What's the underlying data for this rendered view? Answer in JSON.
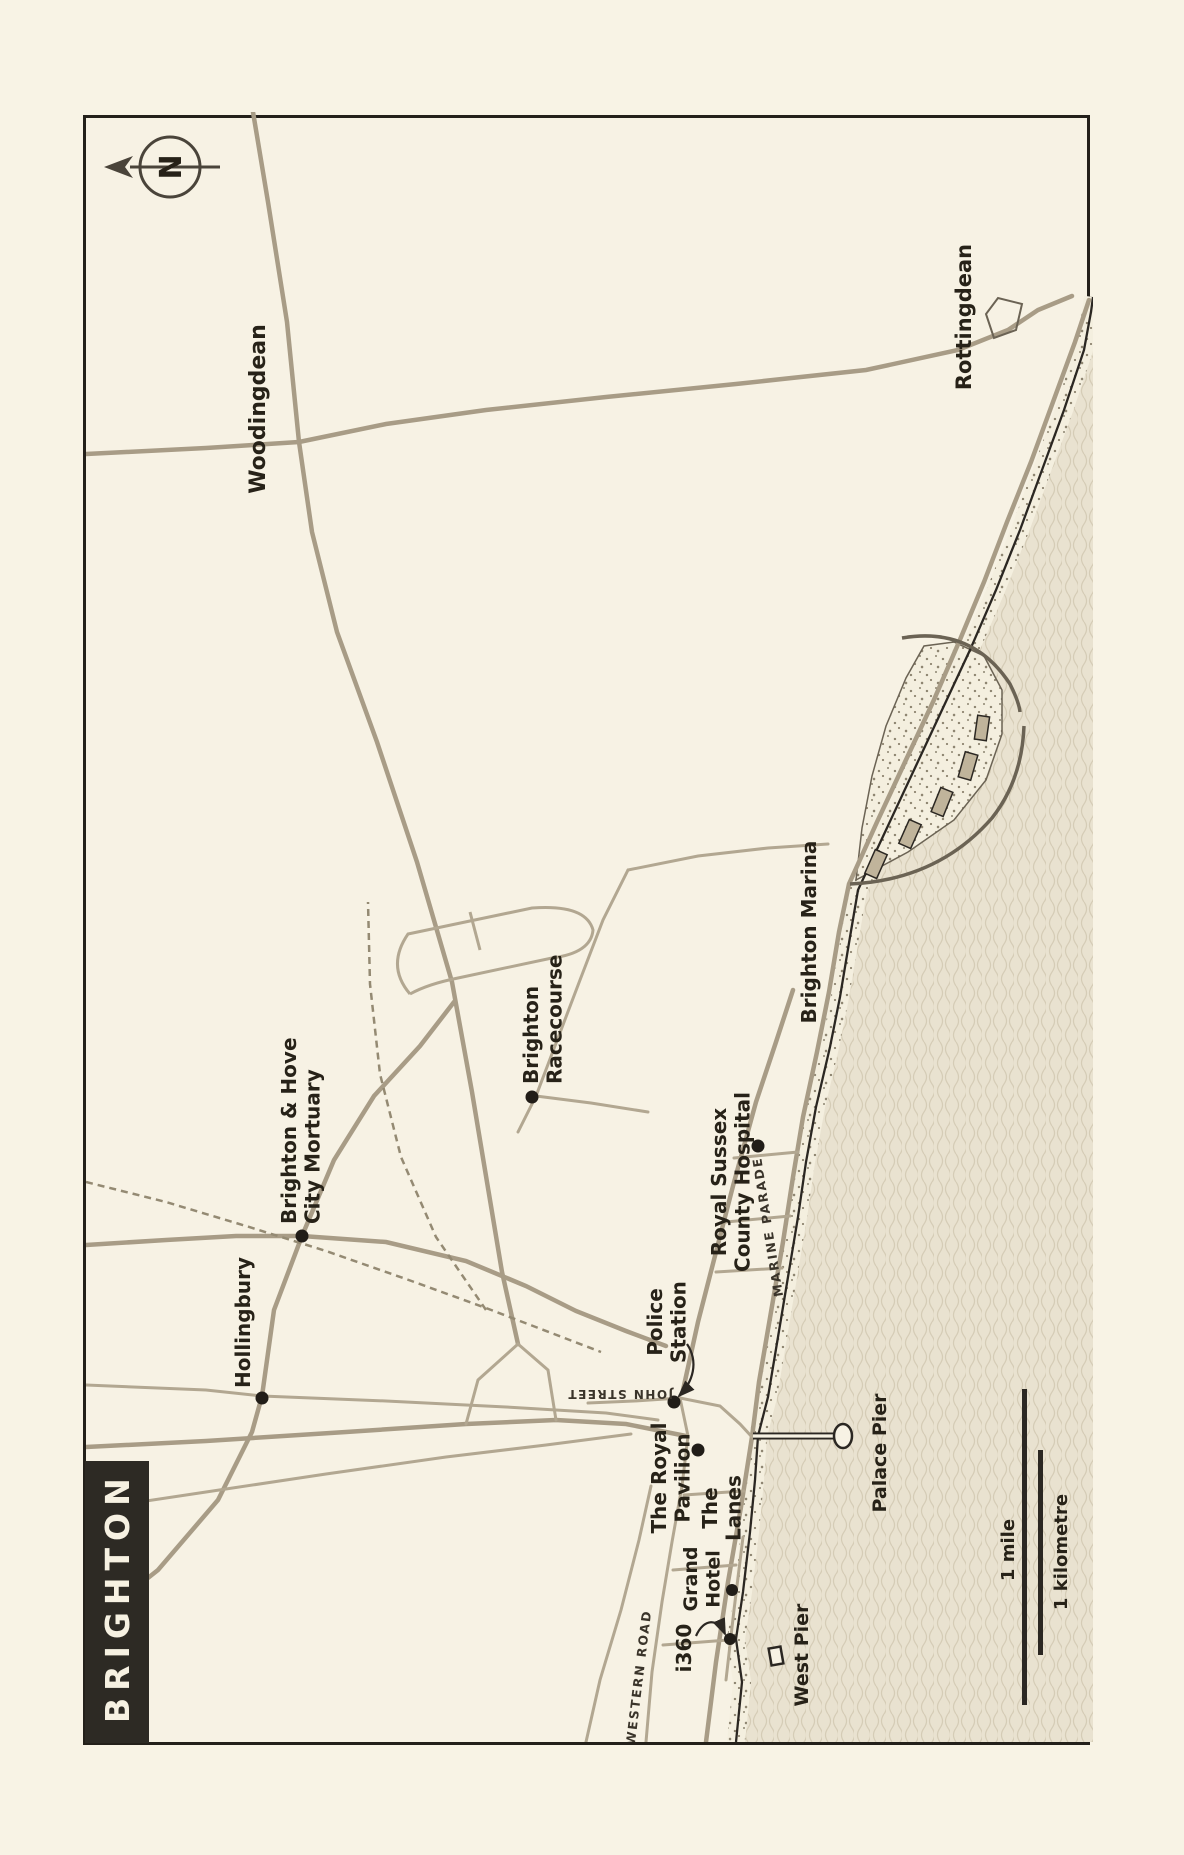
{
  "title": {
    "text": "BRIGHTON"
  },
  "north": {
    "label": "N",
    "x": 1575,
    "y": 84
  },
  "scale_bar": {
    "mile_label": "1 mile",
    "km_label": "1 kilometre",
    "mile_bar": {
      "x": 37,
      "y": 936,
      "w": 316,
      "h": 5
    },
    "km_bar": {
      "x": 87,
      "y": 952,
      "w": 205,
      "h": 5
    },
    "mile_text": {
      "x": 192,
      "y": 928
    },
    "km_text": {
      "x": 190,
      "y": 981
    }
  },
  "colors": {
    "page_bg": "#f8f3e5",
    "map_bg": "#f7f2e4",
    "frame": "#24201a",
    "ink": "#272218",
    "street_ink": "#3a342a",
    "road": "#a89c86",
    "road_minor": "#b2a791",
    "rail": "#948a73",
    "sea_base": "#e9e2d0",
    "sea_wave": "#d5ccb6",
    "beach_base": "#f4efdf",
    "beach_dot": "#8e8571",
    "shore": "#2b2722",
    "structure": "#6b6354",
    "building_fill": "#c0b49b",
    "title_bg": "#2d2a24",
    "title_fg": "#f6f1e2"
  },
  "geometry": {
    "coast": "M0,650 L60,656 L103,650 L150,657 L210,664 L262,669 L306,672 L345,682 L405,692 L465,702 L525,712 L580,720 L635,730 L695,744 L745,754 L805,764 L852,772 L912,800 L972,828 L1032,856 L1092,884 L1152,910 L1212,934 L1272,956 L1332,978 L1392,998 L1430,1005 L1445,1007",
    "sea_close": " L1445,1007 L0,1007 Z",
    "roads_major": [
      "M0,620 L80,630 L160,642 L235,655 L305,666 L360,673 L430,685 L500,697 L565,707 L625,717 L690,731 L750,743 L810,753 L858,763 L920,791 L980,819 L1040,847 L1100,873 L1160,898 L1220,921 L1280,945 L1340,967 L1400,989 L1442,1003",
      "M398,432 L470,416 L560,401 L650,386 L760,366 L880,331 L1000,291 L1110,251 L1210,226 L1300,213 L1420,201 L1540,182 L1630,167",
      "M1300,213 L1318,300 L1332,400 L1345,520 L1358,650 L1372,780 L1392,872 L1412,922 L1432,952 L1446,986",
      "M1300,213 L1294,120 L1290,40 L1288,0",
      "M295,0 L301,120 L310,260 L318,380 L322,470 L318,540 L306,600",
      "M115,0 L172,72 L242,132 L310,166 L346,176 L432,188 L506,216 L582,248 L646,288 L696,334 L740,368",
      "M497,0 L502,80 L506,150 L506,216 L500,300 L481,380 L456,440 L431,490 L411,540 L396,580",
      "M352,597 L420,612 L490,630 L556,647 L640,670 L700,690 L752,707"
    ],
    "roads_minor": [
      "M357,0 L352,120 L346,176 L341,300 L335,420 L329,520 L322,572",
      "M232,0 L250,120 L268,240 L285,360 L297,460 L308,545",
      "M339,502 L341,548 L344,594",
      "M0,560 L70,566 L140,576 L200,586 L256,596 L306,602",
      "M62,640 L132,648 L205,657",
      "M97,577 L102,642",
      "M172,587 L177,650",
      "M247,598 L251,658",
      "M0,500 L62,514 L132,535 L202,553 L256,565",
      "M318,380 L362,392 L398,432",
      "M322,470 L372,462 L398,432",
      "M610,432 L646,450 L704,472 L762,494 L822,517 L872,542",
      "M872,542 L886,612 L894,682 L898,742",
      "M646,450 L639,505 L630,562",
      "M344,594 L336,634 L318,654 L305,666",
      "M584,648 L590,712",
      "M470,630 L474,696",
      "M520,640 L526,704",
      "M306,602 L344,594"
    ],
    "railways": [
      "M560,0 L540,80 L516,160 L491,240 L463,320 L434,400 L408,468 L390,515",
      "M432,400 L505,350 L585,315 L668,294 L758,284 L840,282"
    ],
    "racecourse": [
      "M748,324 Q776,300 808,322 L834,446 Q838,500 812,507 Q789,505 784,466 L764,372 Q758,342 748,324",
      "M792,394 L830,384"
    ],
    "marina_platform": "M862,770 L890,822 L922,868 L962,900 L1008,916 L1052,916 L1086,898 L1100,868 L1096,838 L1064,820 L1016,800 L966,786 L914,776 Z",
    "breakwaters": [
      "M858,764 Q862,852 924,906 Q962,936 1016,938",
      "M1104,816 Q1116,886 1058,924 Q1040,933 1030,934"
    ],
    "buildings": [
      {
        "x": 878,
        "y": 790,
        "w": 26,
        "h": 13,
        "rot": 24
      },
      {
        "x": 908,
        "y": 824,
        "w": 26,
        "h": 13,
        "rot": 24
      },
      {
        "x": 940,
        "y": 856,
        "w": 26,
        "h": 13,
        "rot": 22
      },
      {
        "x": 976,
        "y": 882,
        "w": 26,
        "h": 13,
        "rot": 16
      },
      {
        "x": 1014,
        "y": 896,
        "w": 24,
        "h": 12,
        "rot": 8
      }
    ],
    "village": "M1404,908 L1428,900 L1444,912 L1438,936 L1412,930 Z",
    "palace_pier": {
      "stem": "M306,667 L306,748",
      "bulb": {
        "cx": 306,
        "cy": 757,
        "rx": 12,
        "ry": 9
      }
    },
    "west_pier": {
      "x": 86,
      "y": 690,
      "w": 17,
      "h": 12,
      "rot": -10
    },
    "arrows": [
      "M398,601 C380,613 360,607 346,593",
      "M106,610 C124,618 124,632 108,639"
    ]
  },
  "markers": [
    {
      "id": "hollingbury",
      "x": 344,
      "y": 176,
      "r": 6.5
    },
    {
      "id": "mortuary",
      "x": 506,
      "y": 216,
      "r": 6.5
    },
    {
      "id": "racecourse",
      "x": 645,
      "y": 446,
      "r": 6.5
    },
    {
      "id": "hospital",
      "x": 596,
      "y": 672,
      "r": 6.5
    },
    {
      "id": "police-station",
      "x": 340,
      "y": 588,
      "r": 6.5
    },
    {
      "id": "royal-pavilion",
      "x": 292,
      "y": 612,
      "r": 6.5
    },
    {
      "id": "grand-hotel",
      "x": 152,
      "y": 646,
      "r": 6
    },
    {
      "id": "i360",
      "x": 103,
      "y": 644,
      "r": 6
    }
  ],
  "labels": [
    {
      "id": "woodingdean",
      "lines": [
        "Woodingdean"
      ],
      "x": 1333,
      "y": 179,
      "anchor": "middle",
      "size": 22
    },
    {
      "id": "rottingdean",
      "lines": [
        "Rottingdean"
      ],
      "x": 1425,
      "y": 885,
      "anchor": "middle",
      "size": 21
    },
    {
      "id": "hollingbury",
      "lines": [
        "Hollingbury"
      ],
      "x": 354,
      "y": 164,
      "anchor": "start",
      "size": 20
    },
    {
      "id": "mortuary",
      "lines": [
        "Brighton & Hove",
        "City Mortuary"
      ],
      "x": 518,
      "y": 210,
      "anchor": "start",
      "size": 20
    },
    {
      "id": "racecourse",
      "lines": [
        "Brighton",
        "Racecourse"
      ],
      "x": 658,
      "y": 452,
      "anchor": "start",
      "size": 20
    },
    {
      "id": "hospital",
      "lines": [
        "Royal Sussex",
        "County Hospital"
      ],
      "x": 560,
      "y": 640,
      "anchor": "middle",
      "size": 20
    },
    {
      "id": "police-station",
      "lines": [
        "Police",
        "Station"
      ],
      "x": 420,
      "y": 576,
      "anchor": "middle",
      "size": 20
    },
    {
      "id": "royal-pavilion",
      "lines": [
        "The Royal",
        "Pavilion"
      ],
      "x": 264,
      "y": 580,
      "anchor": "middle",
      "size": 20
    },
    {
      "id": "the-lanes",
      "lines": [
        "The",
        "Lanes"
      ],
      "x": 234,
      "y": 631,
      "anchor": "middle",
      "size": 20
    },
    {
      "id": "grand-hotel",
      "lines": [
        "Grand",
        "Hotel"
      ],
      "x": 163,
      "y": 611,
      "anchor": "middle",
      "size": 19
    },
    {
      "id": "i360",
      "lines": [
        "i360"
      ],
      "x": 94,
      "y": 605,
      "anchor": "middle",
      "size": 20
    },
    {
      "id": "west-pier",
      "lines": [
        "West Pier"
      ],
      "x": 87,
      "y": 722,
      "anchor": "middle",
      "size": 19
    },
    {
      "id": "palace-pier",
      "lines": [
        "Palace Pier"
      ],
      "x": 289,
      "y": 800,
      "anchor": "middle",
      "size": 19
    },
    {
      "id": "brighton-marina",
      "lines": [
        "Brighton Marina"
      ],
      "x": 810,
      "y": 730,
      "anchor": "middle",
      "size": 20
    },
    {
      "id": "marine-parade",
      "lines": [
        "MARINE PARADE"
      ],
      "x": 516,
      "y": 686,
      "anchor": "middle",
      "size": 12.5,
      "rotate": -9,
      "spacing": 2,
      "street": true
    },
    {
      "id": "john-street",
      "lines": [
        "JOHN STREET"
      ],
      "x": 352,
      "y": 534,
      "anchor": "middle",
      "size": 12,
      "rotate": -90,
      "spacing": 1.5,
      "street": true
    },
    {
      "id": "western-road",
      "lines": [
        "WESTERN  ROAD"
      ],
      "x": 64,
      "y": 557,
      "anchor": "middle",
      "size": 12.5,
      "rotate": 7,
      "spacing": 2,
      "street": true
    }
  ]
}
